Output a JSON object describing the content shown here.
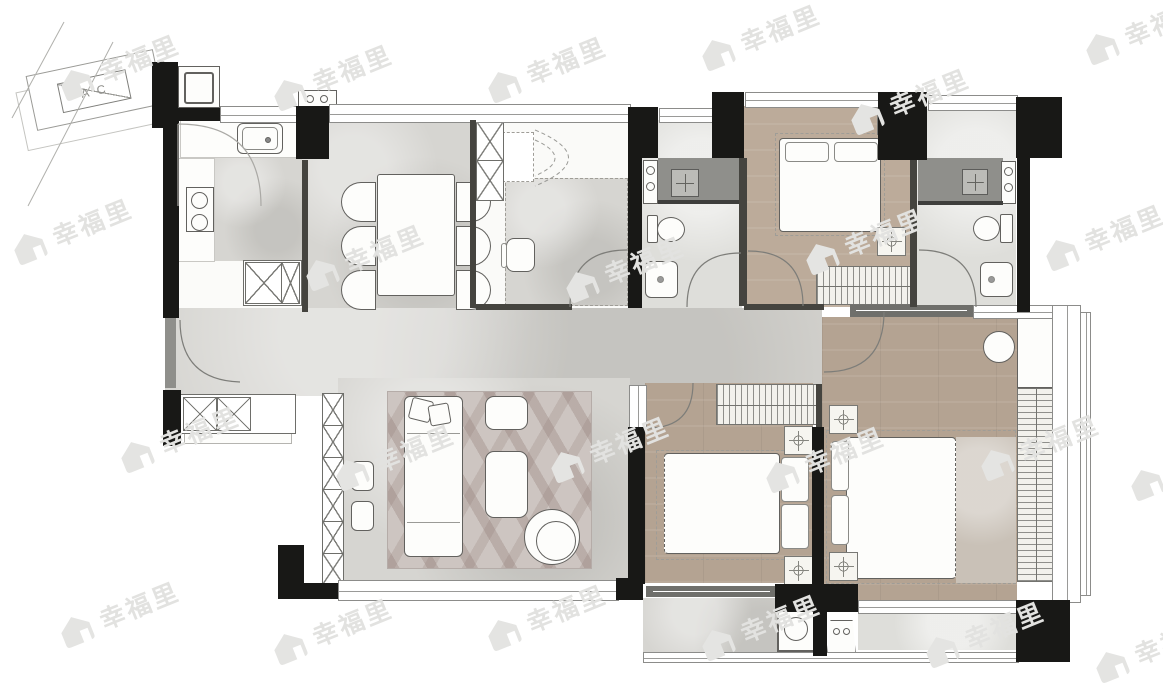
{
  "title": "apartment-floor-plan",
  "ac_platform": {
    "label": "AC"
  },
  "watermark": {
    "text": "幸福里",
    "color": "#e2e2e0",
    "positions": [
      {
        "x": 55,
        "y": 48
      },
      {
        "x": 268,
        "y": 58
      },
      {
        "x": 482,
        "y": 50
      },
      {
        "x": 696,
        "y": 18
      },
      {
        "x": 845,
        "y": 82
      },
      {
        "x": 1080,
        "y": 12
      },
      {
        "x": 8,
        "y": 212
      },
      {
        "x": 300,
        "y": 238
      },
      {
        "x": 560,
        "y": 250
      },
      {
        "x": 800,
        "y": 222
      },
      {
        "x": 1040,
        "y": 218
      },
      {
        "x": 115,
        "y": 420
      },
      {
        "x": 330,
        "y": 438
      },
      {
        "x": 545,
        "y": 430
      },
      {
        "x": 760,
        "y": 440
      },
      {
        "x": 975,
        "y": 428
      },
      {
        "x": 1125,
        "y": 448
      },
      {
        "x": 55,
        "y": 595
      },
      {
        "x": 268,
        "y": 612
      },
      {
        "x": 482,
        "y": 598
      },
      {
        "x": 696,
        "y": 608
      },
      {
        "x": 920,
        "y": 615
      },
      {
        "x": 1090,
        "y": 630
      }
    ]
  },
  "palette": {
    "wall": "#181816",
    "marble_floor": "#d6d5d1",
    "bath_floor": "#dededa",
    "wood_floor": "#b4a392",
    "wood_floor_light": "#bcab9a",
    "shower": "#8f8f8b",
    "rug": "#cdc5c1",
    "watermark": "#e2e2e0",
    "background": "#ffffff"
  },
  "rooms": {
    "note": "no room-name text is printed on the plan; only the AC label and repeated watermark are visible text"
  }
}
